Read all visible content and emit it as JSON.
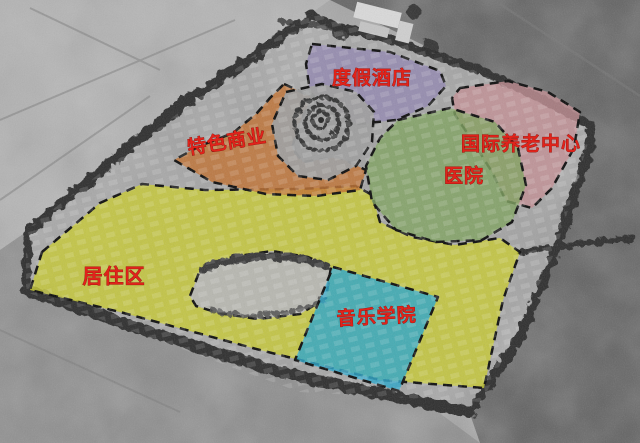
{
  "map": {
    "title": "aerial-master-plan",
    "label_color": "#e0231b",
    "zones": [
      {
        "name": "resort-hotel",
        "label": "度假酒店",
        "color": "#9287b2"
      },
      {
        "name": "specialty-commerce",
        "label": "特色商业",
        "color": "#c17030"
      },
      {
        "name": "international-elderly-care-center",
        "label": "国际养老中心",
        "color": "#c38e94"
      },
      {
        "name": "hospital",
        "label": "医院",
        "color": "#7ea25e"
      },
      {
        "name": "residential",
        "label": "居住区",
        "color": "#c9cc2f"
      },
      {
        "name": "music-college",
        "label": "音乐学院",
        "color": "#2aa6cb"
      }
    ]
  }
}
